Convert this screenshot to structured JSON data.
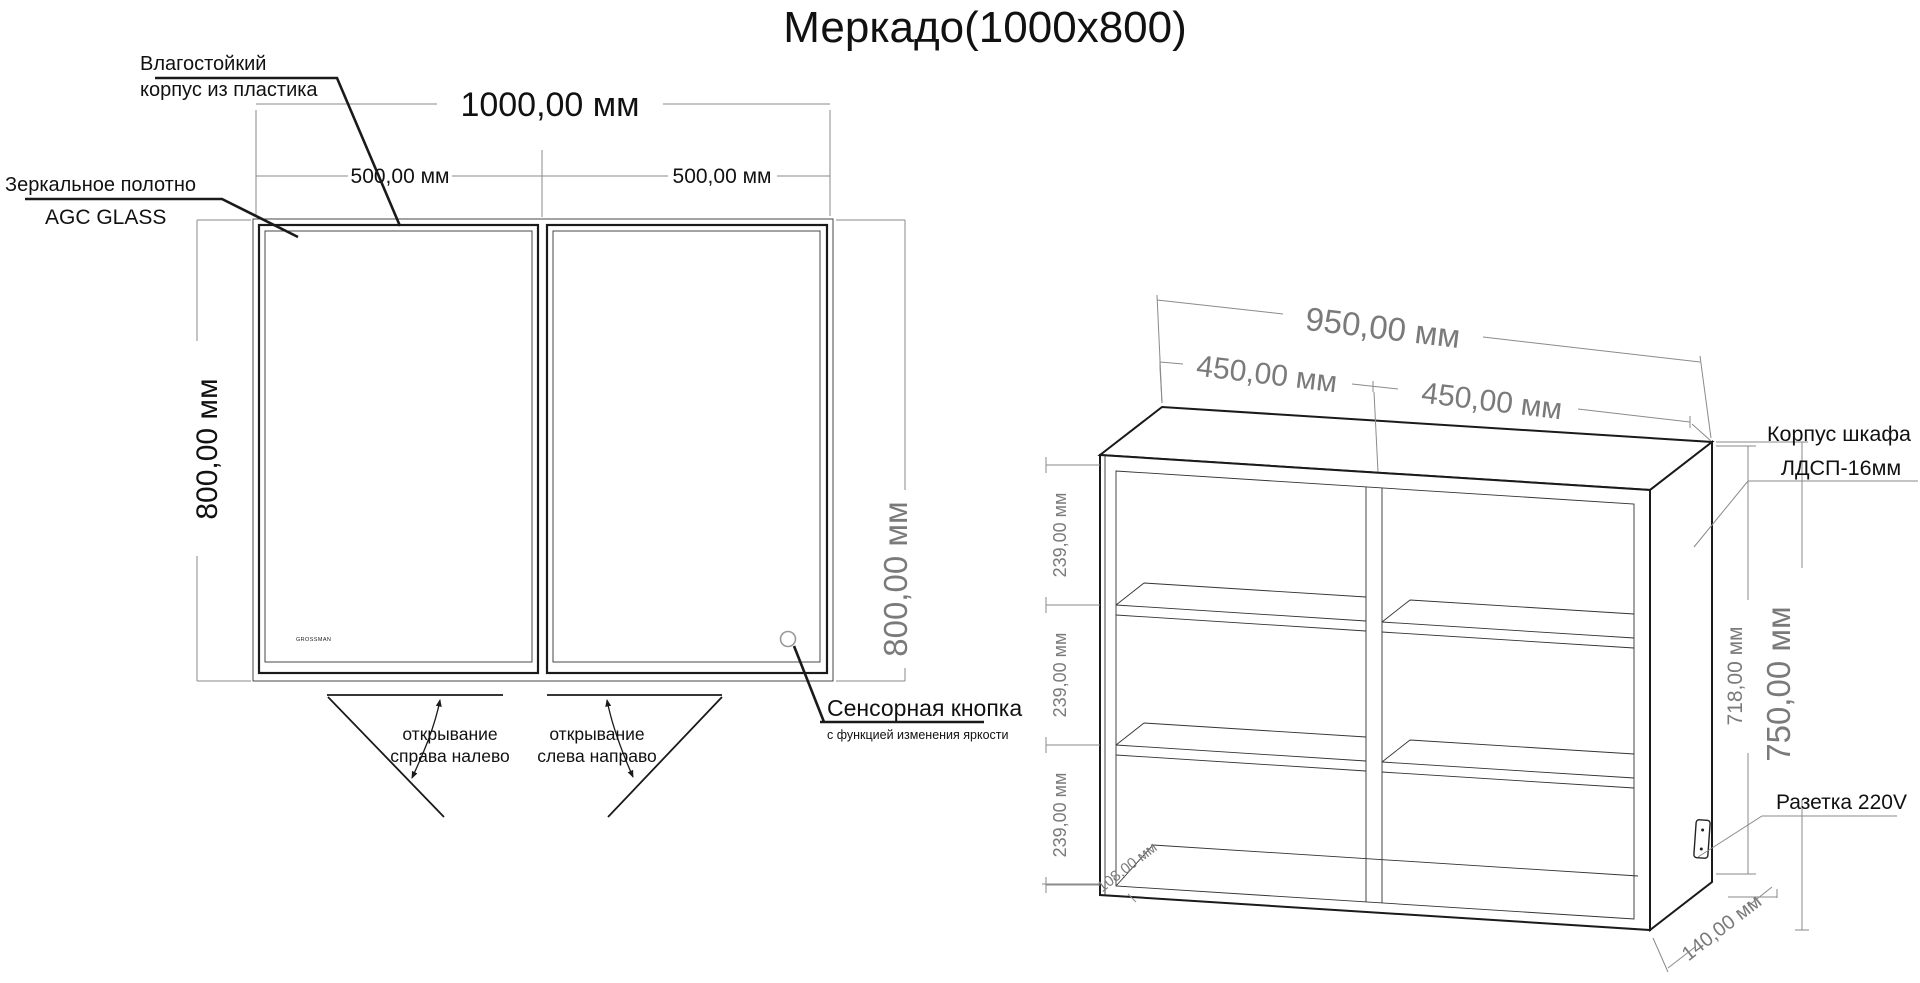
{
  "title": "Меркадо(1000x800)",
  "colors": {
    "drawing_line": "#1a1a1a",
    "dimension_line": "#8a8a8a",
    "dimension_text_gray": "#7a7a7a",
    "text_black": "#111111",
    "background": "#ffffff"
  },
  "front_view": {
    "brand": "GROSSMAN",
    "dims": {
      "total_width": "1000,00 мм",
      "left_door_width": "500,00 мм",
      "right_door_width": "500,00 мм",
      "height_left": "800,00 мм",
      "height_right": "800,00 мм"
    },
    "callouts": {
      "case_l1": "Влагостойкий",
      "case_l2": "корпус из пластика",
      "mirror_l1": "Зеркальное  полотно",
      "mirror_l2": "AGC GLASS",
      "sensor_l1": "Сенсорная кнопка",
      "sensor_l2": "с функцией изменения яркости",
      "open_left_l1": "открывание",
      "open_left_l2": "справа налево",
      "open_right_l1": "открывание",
      "open_right_l2": "слева направо"
    }
  },
  "iso_view": {
    "dims": {
      "total_width": "950,00 мм",
      "left_section": "450,00 мм",
      "right_section": "450,00 мм",
      "shelf_gap_1": "239,00 мм",
      "shelf_gap_2": "239,00 мм",
      "shelf_gap_3": "239,00 мм",
      "inner_height": "718,00 мм",
      "outer_height": "750,00 мм",
      "inner_depth": "108,00 мм",
      "outer_depth": "140,00 мм"
    },
    "callouts": {
      "body_l1": "Корпус шкафа",
      "body_l2": "ЛДСП-16мм",
      "socket": "Разетка 220V"
    }
  }
}
